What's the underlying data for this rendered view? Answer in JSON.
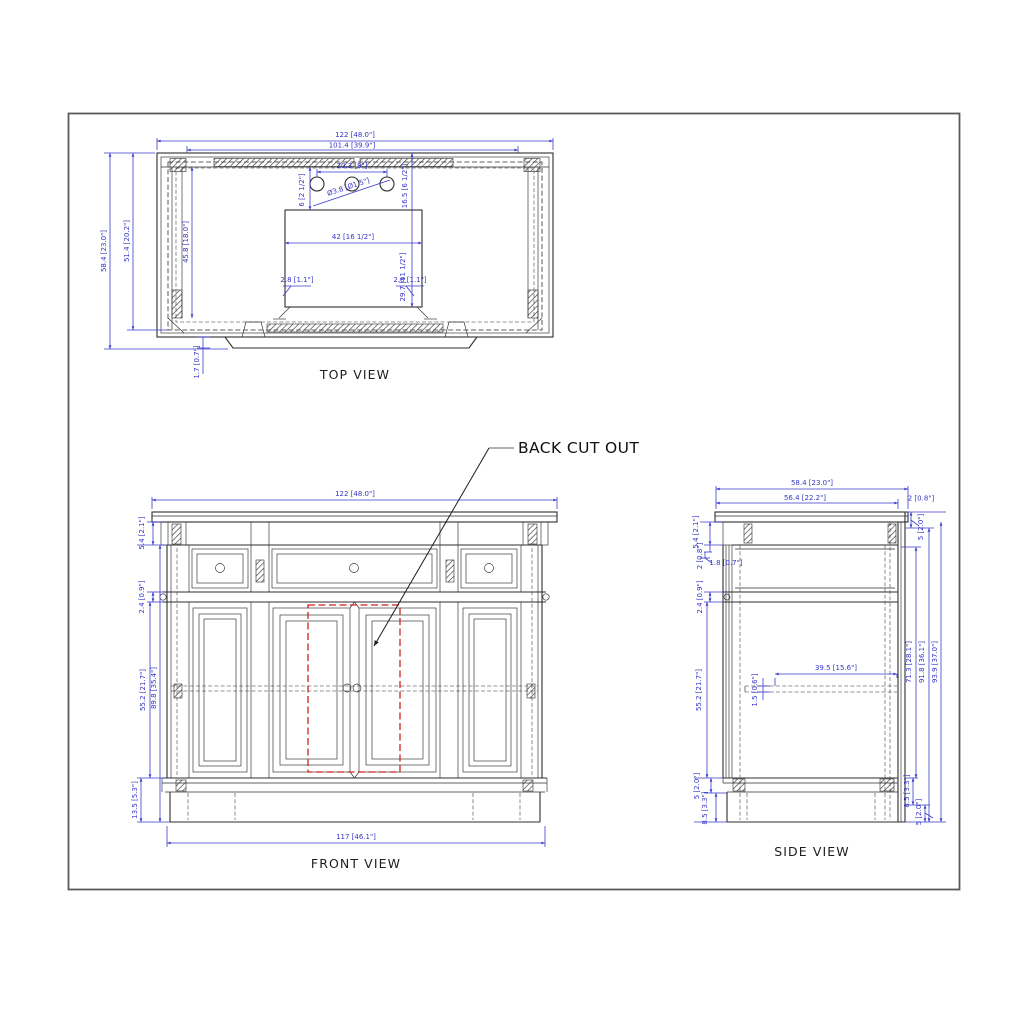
{
  "drawing": {
    "type": "furniture cabinet dimensioned drawing",
    "colors": {
      "dimension": "#3a3acb",
      "line": "#2e2e2e",
      "cutout": "#cc2222",
      "frame": "#5a5a5a"
    },
    "views": {
      "top": {
        "title": "TOP VIEW",
        "dims": {
          "overall_width": "122 [48.0\"]",
          "back_rail_width": "101.4 [39.9\"]",
          "overall_depth": "58.4 [23.0\"]",
          "counter_depth": "51.4 [20.2\"]",
          "interior_depth": "45.8 [18.0\"]",
          "back_step": "1.7 [0.7\"]",
          "faucet_spacing": "20.3 [8\"]",
          "faucet_hole_dia": "Ø3.8 [Ø1.5\"]",
          "faucet_setback": "6 [2 1/2\"]",
          "sink_setback": "16.5 [6 1/2\"]",
          "sink_width": "42 [16 1/2\"]",
          "sink_depth": "29.7 [11 1/2\"]",
          "corner_left": "2.8 [1.1\"]",
          "corner_right": "2.8 [1.1\"]"
        }
      },
      "front": {
        "title": "FRONT VIEW",
        "callout": "BACK CUT OUT",
        "dims": {
          "overall_width": "122 [48.0\"]",
          "cornice_height": "5.4 [2.1\"]",
          "rail_height": "2.4 [0.9\"]",
          "door_height": "55.2 [21.7\"]",
          "body_height": "89.8 [35.4\"]",
          "base_height": "13.5 [5.3\"]",
          "base_width": "117 [46.1\"]"
        }
      },
      "side": {
        "title": "SIDE VIEW",
        "dims": {
          "overall_depth": "58.4 [23.0\"]",
          "top_depth": "56.4 [22.2\"]",
          "back_panel": "2 [0.8\"]",
          "cornice_height": "5.4 [2.1\"]",
          "top_gap": "2 [0.8\"]",
          "lip": "1.8 [0.7\"]",
          "rail_height": "2.4 [0.9\"]",
          "top_right": "5 [2.0\"]",
          "door_height": "55.2 [21.7\"]",
          "shelf_depth": "39.5 [15.6\"]",
          "shelf_thickness": "1.5 [0.6\"]",
          "interior_height": "71.3 [28.1\"]",
          "body_height": "91.8 [36.1\"]",
          "overall_height": "93.9 [37.0\"]",
          "base_right": "8.5 [3.3\"]",
          "bottom_right": "5 [2.0\"]",
          "base_left_upper": "5 [2.0\"]",
          "base_left_lower": "8.5 [3.3\"]"
        }
      }
    }
  }
}
